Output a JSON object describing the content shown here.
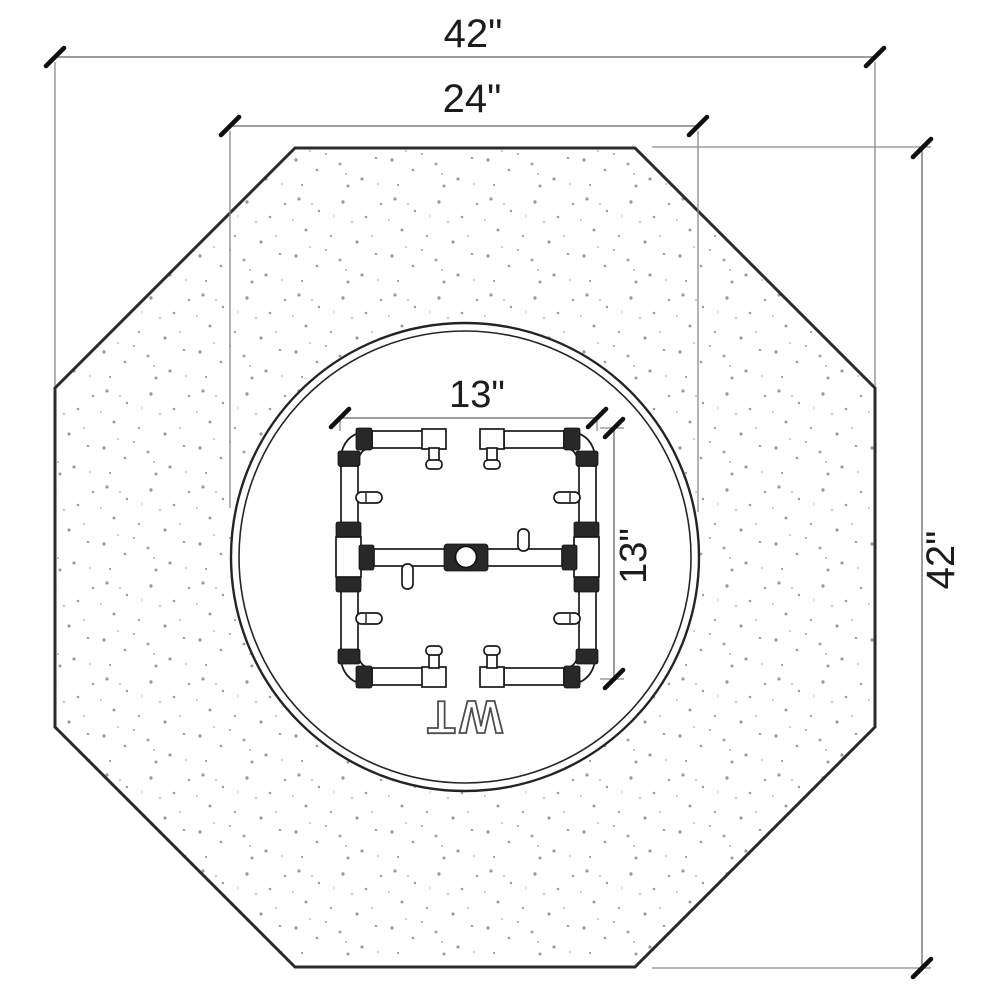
{
  "drawing": {
    "watermark": "WT",
    "dimensions": {
      "overall_width": "42\"",
      "overall_height": "42\"",
      "bowl_diameter": "24\"",
      "burner_width": "13\"",
      "burner_depth": "13\""
    },
    "colors": {
      "background": "#ffffff",
      "octagon_outline": "#2b2b2b",
      "bowl_outline": "#242424",
      "dimension_lines": "#7d7d7d",
      "dimension_text": "#1c1c1c",
      "fittings": "#282828",
      "speckle": "#8a8a8a"
    }
  }
}
